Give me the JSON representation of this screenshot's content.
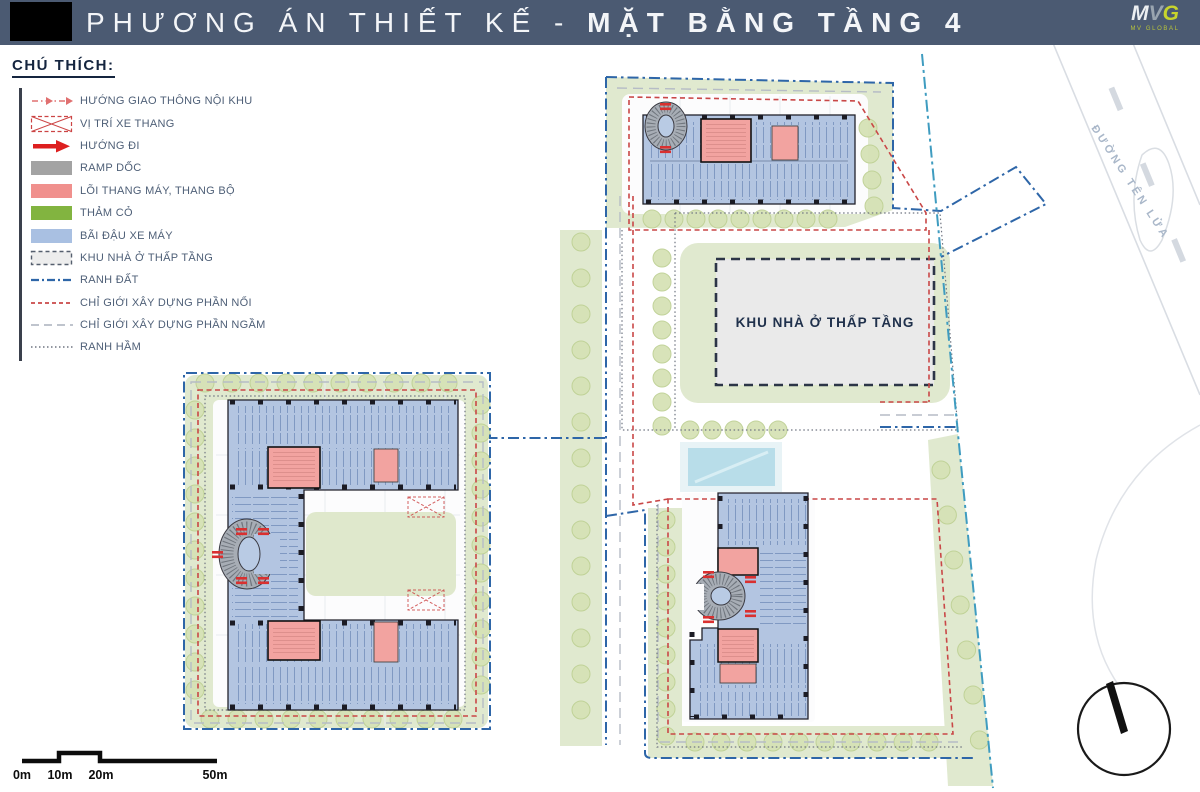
{
  "title": {
    "prefix": "PHƯƠNG ÁN THIẾT KẾ - ",
    "emphasis": "MẶT BẰNG TẦNG 4"
  },
  "logo": {
    "mark_letters": [
      "M",
      "V",
      "G"
    ],
    "subtext": "MV GLOBAL"
  },
  "legend": {
    "heading": "CHÚ THÍCH:",
    "items": [
      {
        "id": "huong-giao-thong-noi-khu",
        "symbol": "dash-dot-arrow",
        "color": "#e07070",
        "label": "HƯỚNG GIAO THÔNG NỘI KHU"
      },
      {
        "id": "vi-tri-xe-thang",
        "symbol": "crossed-box",
        "color": "#cc4444",
        "label": "VỊ TRÍ XE THANG"
      },
      {
        "id": "huong-di",
        "symbol": "solid-arrow",
        "color": "#dd1f1f",
        "label": "HƯỚNG ĐI"
      },
      {
        "id": "ramp-doc",
        "symbol": "rect",
        "color": "#a3a3a3",
        "label": "RAMP DỐC"
      },
      {
        "id": "loi-thang-may-thang-bo",
        "symbol": "rect",
        "color": "#f0908d",
        "label": "LÕI THANG MÁY, THANG BỘ"
      },
      {
        "id": "tham-co",
        "symbol": "rect",
        "color": "#82b440",
        "label": "THẢM CỎ"
      },
      {
        "id": "bai-dau-xe-may",
        "symbol": "rect",
        "color": "#a9c0e2",
        "label": "BÃI ĐẬU XE MÁY"
      },
      {
        "id": "khu-nha-o-thap-tang",
        "symbol": "dashed-box",
        "color": "#ededed",
        "label": "KHU NHÀ Ở THẤP TẦNG"
      },
      {
        "id": "ranh-dat",
        "symbol": "dash-dot-line",
        "color": "#2e66a8",
        "label": "RANH ĐẤT"
      },
      {
        "id": "chi-gioi-xay-dung-phan-noi",
        "symbol": "dashed-line",
        "color": "#c94747",
        "label": "CHỈ GIỚI XÂY DỰNG PHẦN NỔI"
      },
      {
        "id": "chi-gioi-xay-dung-phan-ngam",
        "symbol": "long-dash-line",
        "color": "#b6bcc6",
        "label": "CHỈ GIỚI XÂY DỰNG PHẦN NGẦM"
      },
      {
        "id": "ranh-ham",
        "symbol": "dotted-line",
        "color": "#6f7581",
        "label": "RANH HẦM"
      }
    ]
  },
  "map": {
    "low_rise_label": "KHU NHÀ Ở THẤP TẦNG",
    "road_label": "ĐƯỜNG TÊN LỬA"
  },
  "scale_bar": {
    "labels": [
      "0m",
      "10m",
      "20m",
      "50m"
    ]
  },
  "colors": {
    "title_bar": "#4b5a72",
    "parking_blue": "#b3c5e1",
    "core_pink": "#f2a3a0",
    "grass_green": "#e0e9cf",
    "ramp_grey": "#a7adb5",
    "boundary_blue": "#2e66a8",
    "boundary_cyan": "#3f9cc0",
    "boundary_red": "#c94747",
    "low_rise_fill": "#eaeaea"
  }
}
